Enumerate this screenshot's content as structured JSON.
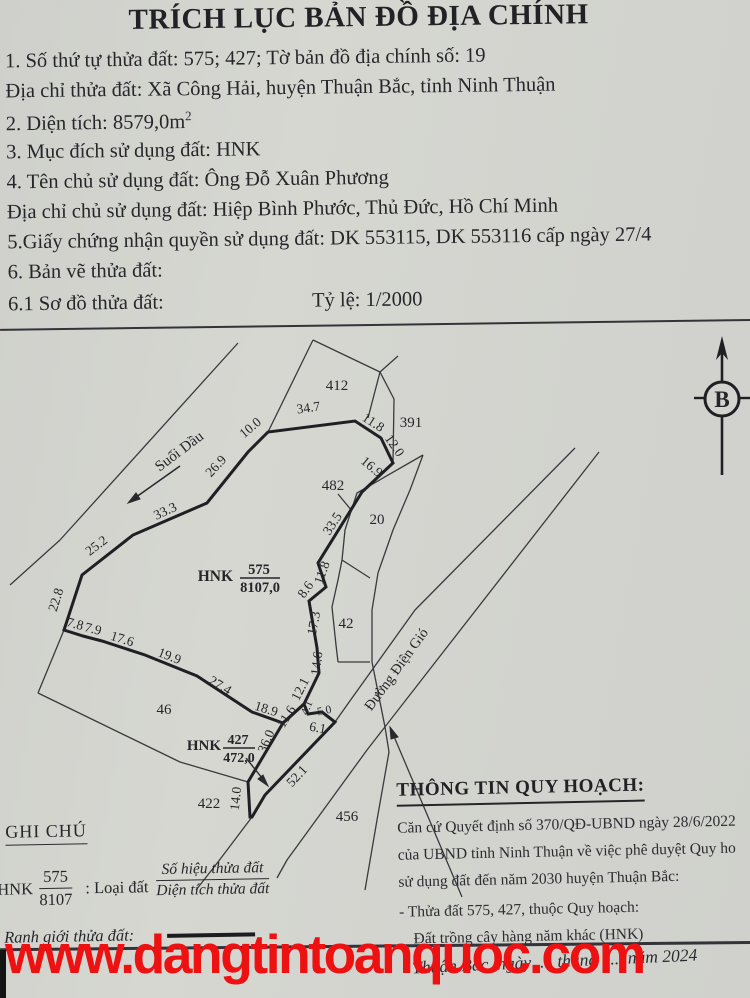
{
  "document": {
    "title": "TRÍCH LỤC BẢN ĐỒ ĐỊA CHÍNH",
    "line1": "1. Số thứ tự thửa đất: 575; 427;  Tờ bản đồ địa chính số: 19",
    "line2": "Địa chỉ thửa đất: Xã Công Hải, huyện Thuận Bắc, tỉnh Ninh Thuận",
    "line3": "2. Diện tích: 8579,0m",
    "line3_sup": "2",
    "line4": "3. Mục đích sử dụng đất: HNK",
    "line5": "4. Tên chủ sử dụng đất: Ông Đỗ Xuân Phương",
    "line6": "Địa chỉ chủ sử dụng đất: Hiệp Bình Phước, Thủ Đức, Hồ Chí Minh",
    "line7": "5.Giấy chứng nhận quyền sử dụng đất: DK 553115, DK 553116 cấp ngày 27/4",
    "line8": "6. Bản vẽ thửa đất:",
    "line9": "6.1 Sơ đồ thửa đất:",
    "scale": "Tỷ lệ: 1/2000"
  },
  "map": {
    "north_label": "B",
    "stream_label": "Suối Dầu",
    "road_label": "Đường Điện Gió",
    "parcel575": {
      "code": "HNK",
      "num": "575",
      "area": "8107,0"
    },
    "parcel427": {
      "code": "HNK",
      "num": "427",
      "area": "472,0"
    },
    "neighbors": [
      "412",
      "391",
      "482",
      "20",
      "42",
      "46",
      "422",
      "456"
    ],
    "measurements": [
      "34.7",
      "10.0",
      "26.9",
      "33.3",
      "25.2",
      "22.8",
      "7.8",
      "7.9",
      "17.6",
      "19.9",
      "27.4",
      "18.9",
      "11.6",
      "12.1",
      "4.1",
      "5.0",
      "6.1",
      "36.0",
      "52.1",
      "14.0",
      "11.8",
      "12.0",
      "16.9",
      "33.5",
      "11.8",
      "8.6",
      "17.3",
      "14.6"
    ]
  },
  "notes": {
    "heading": "GHI CHÚ",
    "legend_code": "HNK",
    "legend_num": "575",
    "legend_den": "8107",
    "legend_sep": ": Loại đất",
    "legend_top": "Số hiệu thửa đất",
    "legend_bottom": "Diện tích thửa đất",
    "boundary_label": "Ranh giới thửa đất:"
  },
  "planning": {
    "heading": "THÔNG TIN QUY HOẠCH:",
    "para": [
      "Căn cứ Quyết định số 370/QĐ-UBND ngày 28/6/2022",
      "của UBND tỉnh Ninh Thuận về việc phê duyệt Quy ho",
      "sử dụng đất đến năm 2030 huyện Thuận Bắc:",
      "- Thửa đất 575, 427, thuộc Quy hoạch:",
      "Đất trồng cây hàng năm khác  (HNK)"
    ]
  },
  "footer": {
    "watermark": "www.dangtintoanquoc.com",
    "date_line": "Thuận Bắc, ngày .... tháng ..... năm 2024"
  },
  "colors": {
    "paper": "#d3d4cf",
    "ink": "#26262a",
    "watermark_red": "#ee1111"
  }
}
